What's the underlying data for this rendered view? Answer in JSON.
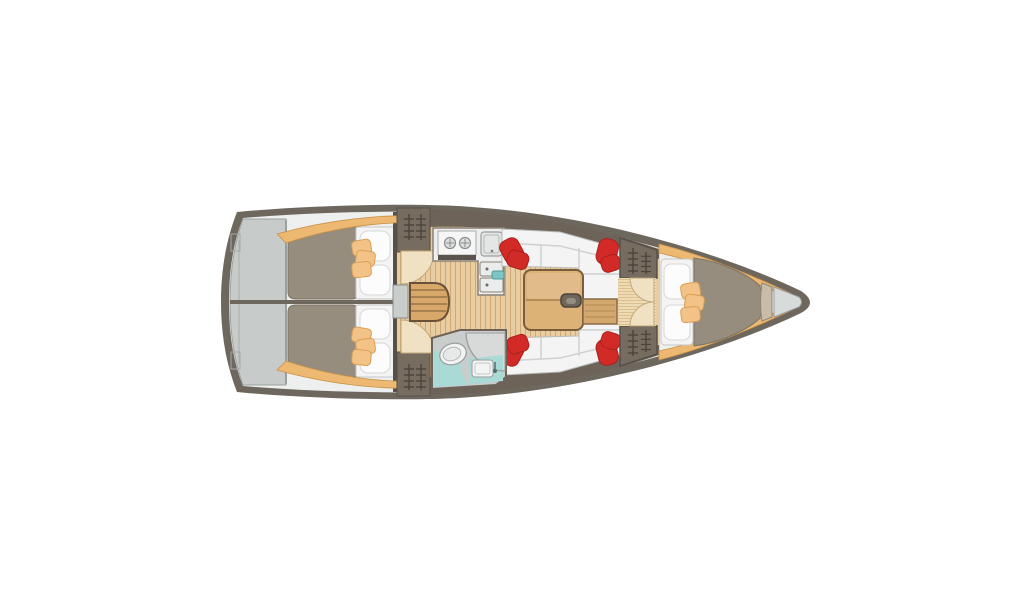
{
  "title": "Sailing yacht interior layout plan (top view)",
  "palette": {
    "background": "#ffffff",
    "hull": "#6e675e",
    "deck": "#eef0ef",
    "platform": "#c7cbca",
    "platform_line": "#9aa09e",
    "floor": "#e9cda2",
    "floor_line": "#cfa873",
    "passage_floor": "#eedbb4",
    "passage_line": "#d9bc8a",
    "trim": "#ecb872",
    "trim_edge": "#c89045",
    "cabinet": "#776c60",
    "cabinet_dark": "#6d6358",
    "louver": "#4a443c",
    "mattress": "#968d7e",
    "bedding": "#f3f4f3",
    "bedding_edge": "#c5c8c7",
    "pillow_white": "#fbfcfb",
    "pillow_tan": "#f2c287",
    "pillow_tan_edge": "#d99f55",
    "pillow_red": "#d22b27",
    "pillow_red_edge": "#a8201d",
    "table": "#dcb277",
    "table_edge": "#7b5c3b",
    "table_leaf": "#d3a86e",
    "steps": "#d8a86b",
    "steps_edge": "#6b5138",
    "door_arc": "#f0e1c3",
    "door_arc_edge": "#c2a87c",
    "counter": "#edefee",
    "counter_edge": "#8b8174",
    "appliance": "#e3e6e5",
    "appliance_edge": "#9a9d9c",
    "stove_strip": "#5a544c",
    "teal": "#a9dad6",
    "teal_accent": "#7ec4c4",
    "bath_wall": "#c9cdcc",
    "bath_edge": "#6d6358",
    "anchor_locker": "#d7dbda",
    "bow_strip": "#c9bda9",
    "outline": "#57504a"
  },
  "areas": {
    "swim_platform": "stern-platform",
    "aft_cabin_port": "aft-double-berth-port",
    "aft_cabin_starboard": "aft-double-berth-starboard",
    "companionway": "companionway-steps",
    "galley": "galley-two-burner-stove-and-sinks",
    "head": "head-with-toilet-basin-shower",
    "saloon": "saloon-settees-and-folding-table",
    "forward_cabin": "forward-v-berth",
    "anchor_locker": "bow-anchor-locker"
  }
}
